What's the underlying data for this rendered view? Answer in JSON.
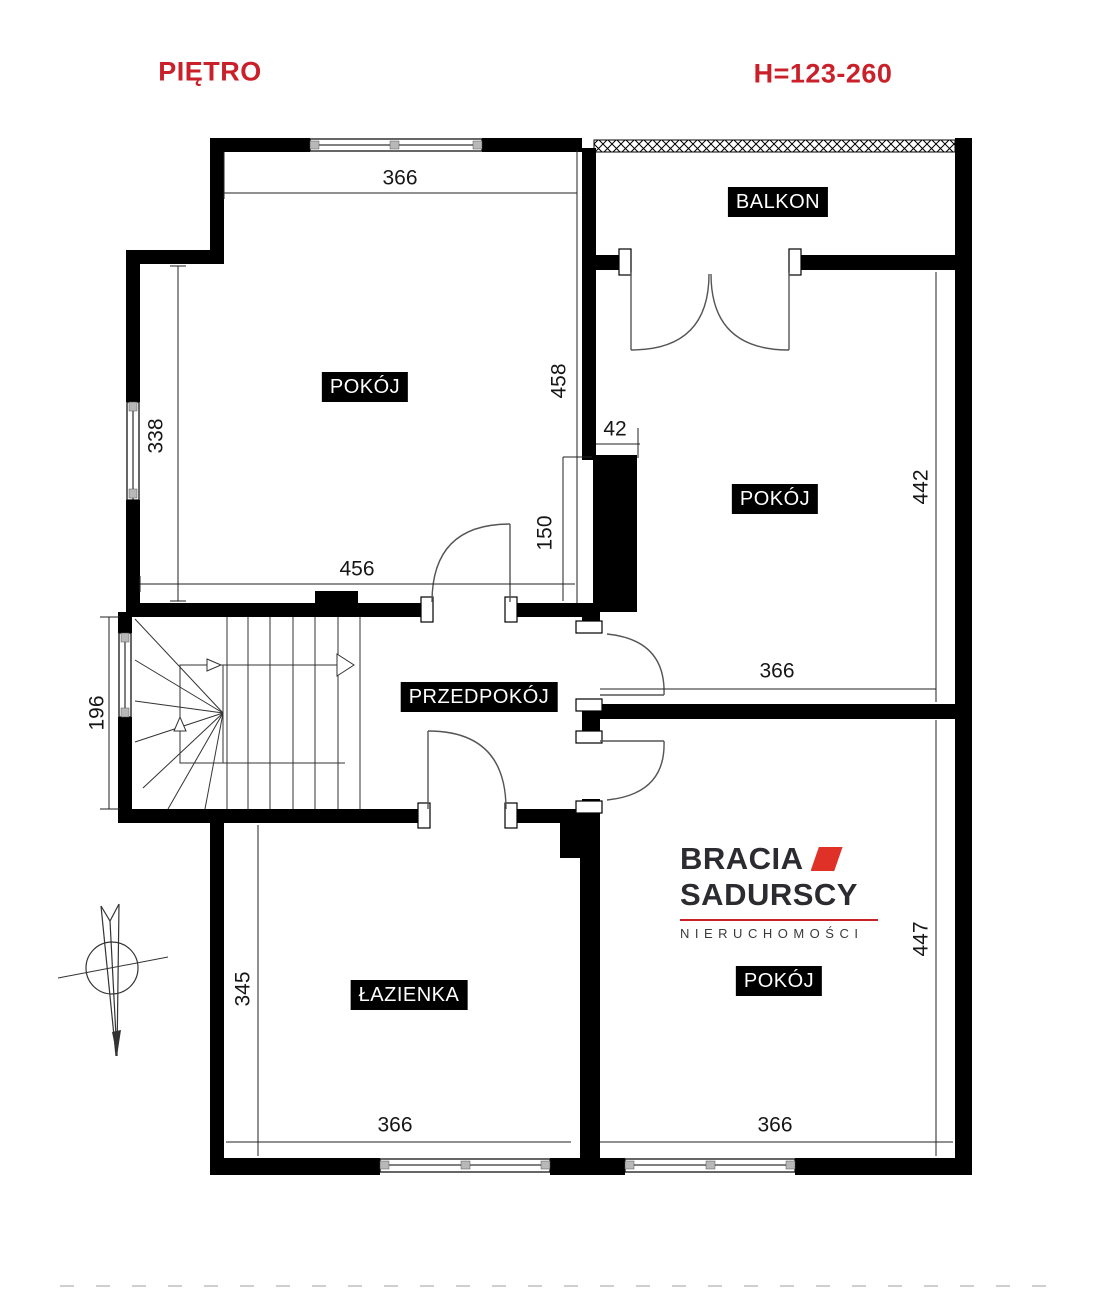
{
  "header": {
    "title": "PIĘTRO",
    "height_note": "H=123-260"
  },
  "rooms": {
    "room_top_left": "POKÓJ",
    "balcony": "BALKON",
    "room_top_right": "POKÓJ",
    "hallway": "PRZEDPOKÓJ",
    "bathroom": "ŁAZIENKA",
    "room_bottom_right": "POKÓJ"
  },
  "dims": {
    "tl_top": "366",
    "tl_right": "458",
    "tl_left": "338",
    "tl_bottom": "456",
    "stairs_left": "196",
    "pillar_width": "42",
    "pillar_height": "150",
    "tr_right": "442",
    "tr_bottom": "366",
    "br_right": "447",
    "br_bottom": "366",
    "bath_left": "345",
    "bath_bottom": "366"
  },
  "logo": {
    "line1": "BRACIA",
    "line2": "SADURSCY",
    "tagline": "NIERUCHOMOŚCI"
  },
  "colors": {
    "wall": "#000000",
    "line": "#3a3a3a",
    "accent_red": "#c9202a",
    "logo_red": "#e03128",
    "logo_ink": "#2b2b30"
  }
}
